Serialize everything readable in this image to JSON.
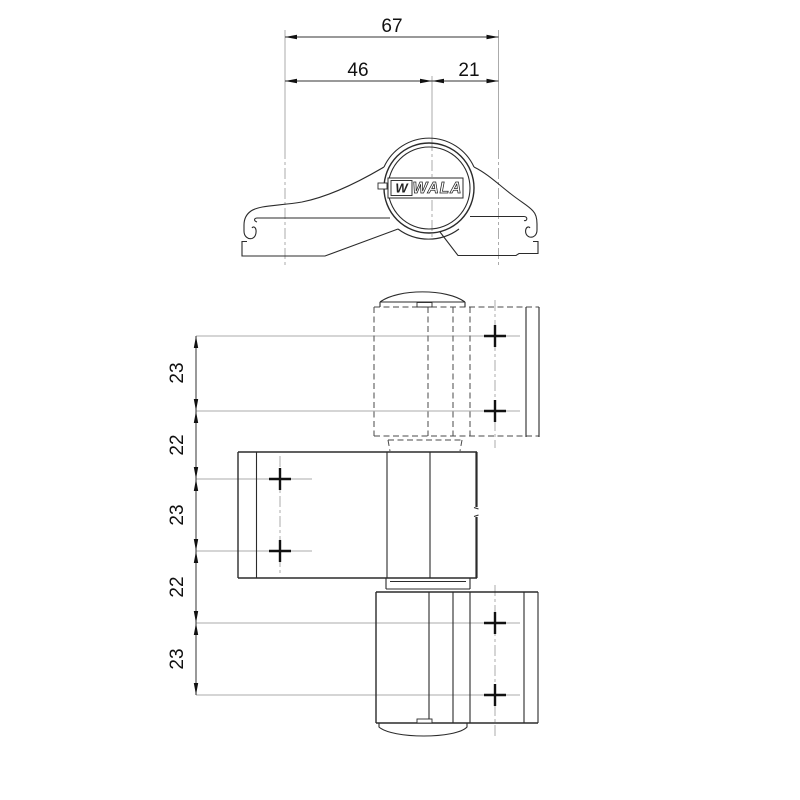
{
  "top_view": {
    "dimensions": {
      "overall": "67",
      "pivot_offset": "46",
      "edge_offset": "21"
    },
    "logo": {
      "mark": "W",
      "text": "WALA"
    }
  },
  "front_view": {
    "dimensions": [
      "23",
      "22",
      "23",
      "22",
      "23"
    ]
  },
  "colors": {
    "line": "#2b2b2b",
    "hidden_line": "#4a4a4a",
    "construction": "#ababab",
    "text": "#111111",
    "background": "#ffffff"
  }
}
